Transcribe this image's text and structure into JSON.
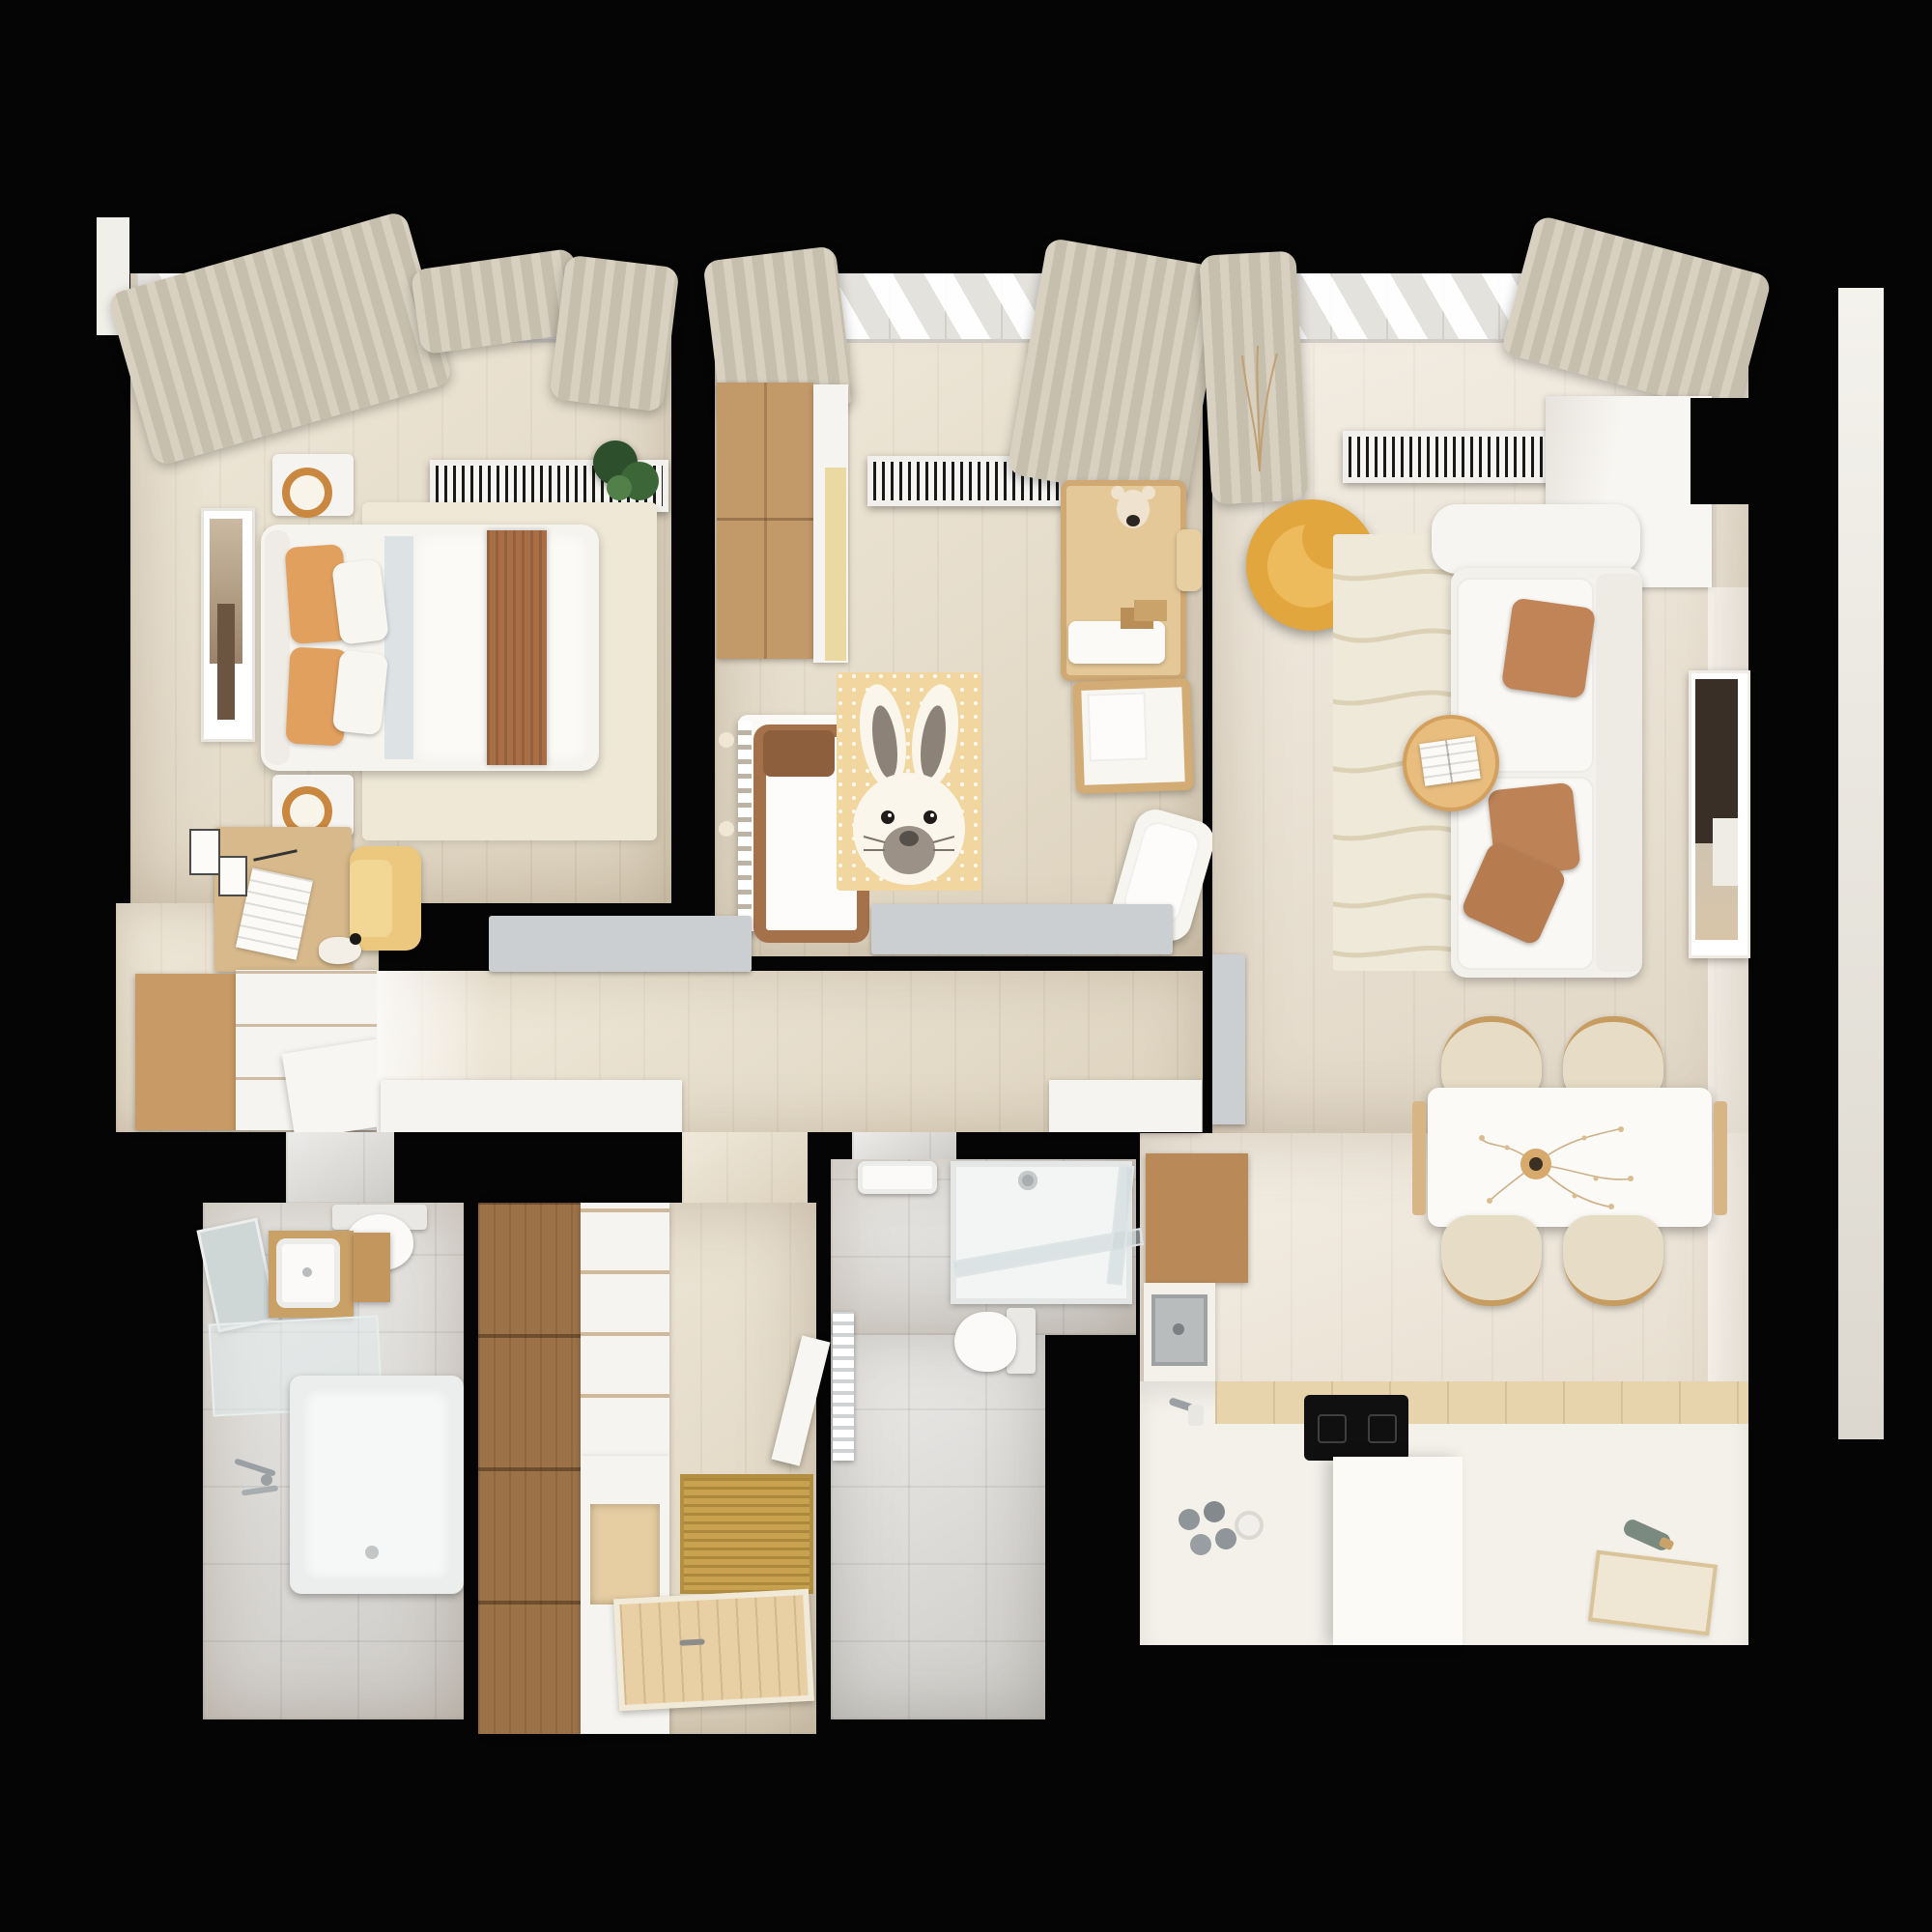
{
  "scene": {
    "kind": "3d-rendered-apartment-floor-plan-top-view",
    "background_color": "#050505",
    "no_visible_text": true
  },
  "palette": {
    "wall_void": "#050505",
    "wood_floor": "#e8ddc7",
    "light_wood_floor": "#ece1cf",
    "tile_floor": "#dad8d4",
    "rug_cream": "#efe8d7",
    "curtain_beige": "#d3cbbb",
    "accent_orange_pillow": "#e2a05e",
    "accent_brown_blanket": "#a96e46",
    "accent_yellow_armchair": "#e2a63e",
    "accent_pale_yellow_chair": "#ecc87e",
    "nursery_rug_yellow": "#f1d79f",
    "wardrobe_wood": "#c29a69",
    "closet_wood_dark": "#9c7348",
    "gray_furniture": "#cbcfd1",
    "kitchen_counter_white": "#f4f1ea",
    "cooktop_black": "#101010"
  },
  "rooms": [
    {
      "name": "bedroom",
      "furniture": [
        "double-bed",
        "orange-pillows",
        "white-pillows",
        "brown-throw-blanket",
        "nightstand-with-lamp-top",
        "nightstand-with-lamp-bottom",
        "wall-art",
        "area-rug",
        "radiator",
        "window",
        "curtains",
        "potted-plant",
        "desk",
        "yellow-chair",
        "dresser-white",
        "dresser-wood-panel",
        "bird-figurine",
        "small-wall-frames",
        "leaning-panel-door"
      ]
    },
    {
      "name": "nursery",
      "furniture": [
        "wardrobe",
        "white-yellow-cabinet",
        "radiator",
        "window",
        "curtains",
        "changing-table",
        "teddy-bear",
        "toy-blocks",
        "small-chair",
        "play-table",
        "crib-with-brown-bedding",
        "bunny-rug",
        "white-lounge-chair",
        "gray-sideboard",
        "wall-lamps"
      ]
    },
    {
      "name": "living-room",
      "furniture": [
        "window",
        "curtains",
        "dried-grass-decor",
        "radiator",
        "yellow-swivel-armchair",
        "textured-cream-rug",
        "white-sectional-sofa",
        "terracotta-cushions",
        "round-coffee-table",
        "open-book",
        "tall-dark-artwork",
        "built-in-white-cabinet"
      ]
    },
    {
      "name": "dining-area",
      "furniture": [
        "white-dining-table",
        "wood-table-rails",
        "four-cream-chairs",
        "vase-with-dried-flowers"
      ]
    },
    {
      "name": "kitchen",
      "furniture": [
        "gray-appliance-column",
        "tall-wood-cabinet",
        "white-counter-L",
        "steel-sink",
        "faucet",
        "wood-counter-strip",
        "induction-cooktop",
        "white-island-block",
        "bottle-group",
        "green-bottle",
        "cutting-board"
      ]
    },
    {
      "name": "hallway",
      "furniture": [
        "white-low-cabinet",
        "gray-bench",
        "white-side-band"
      ]
    },
    {
      "name": "bathroom-1",
      "furniture": [
        "toilet",
        "mirror",
        "wood-vanity-with-basin",
        "wood-cabinet",
        "glass-shelf",
        "bathtub",
        "wall-faucet"
      ]
    },
    {
      "name": "walk-in-closet",
      "furniture": [
        "brown-wardrobe-column",
        "white-drawer-unit",
        "open-niche",
        "jute-mat",
        "wood-slat-mat",
        "open-door-leaf"
      ]
    },
    {
      "name": "bathroom-2",
      "furniture": [
        "wall-sink",
        "shower-tray",
        "glass-shower-screens",
        "shower-head",
        "toilet",
        "radiator"
      ]
    }
  ],
  "exterior": [
    "white-ledge-right",
    "white-notch-top-left"
  ]
}
